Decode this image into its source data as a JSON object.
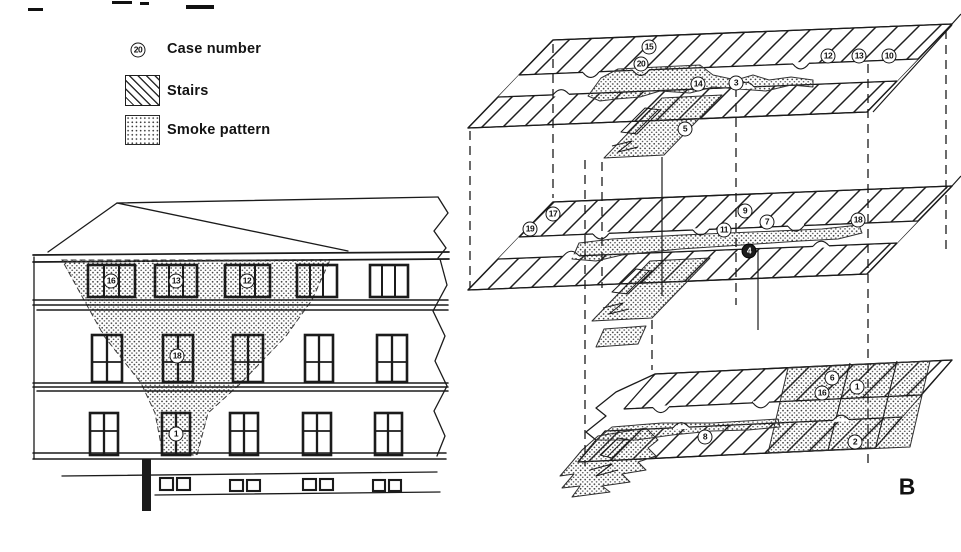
{
  "legend": {
    "case_symbol": "20",
    "items": [
      {
        "label": "Case number"
      },
      {
        "label": "Stairs"
      },
      {
        "label": "Smoke pattern"
      }
    ]
  },
  "figure_label": "B",
  "case_numbers": {
    "elevation": {
      "top_windows": [
        "16",
        "13",
        "12"
      ],
      "middle_window": "18",
      "ground_window": "1"
    },
    "iso_top": [
      "15",
      "20",
      "14",
      "3",
      "12",
      "13",
      "10",
      "5"
    ],
    "iso_middle": [
      "17",
      "19",
      "9",
      "7",
      "11",
      "4",
      "18"
    ],
    "iso_bottom": [
      "8",
      "6",
      "16",
      "1",
      "2"
    ]
  }
}
